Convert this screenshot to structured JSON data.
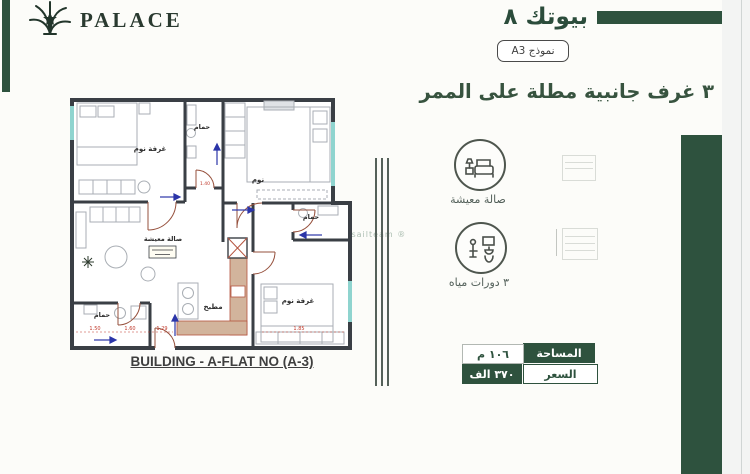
{
  "brand": {
    "palace_label": "PALACE",
    "arabic_wordmark": "بيوتك ٨",
    "model_badge": "نموذج A3"
  },
  "headline": "٣ غرف جانبية مطلة على الممر",
  "features": [
    {
      "icon": "sofa-icon",
      "label": "صالة معيشة"
    },
    {
      "icon": "toilet-icon",
      "label": "٣ دورات مياه"
    }
  ],
  "specs": {
    "area_label": "المساحة",
    "area_value": "١٠٦ م",
    "price_label": "السعر",
    "price_value": "٣٧٠ الف"
  },
  "floor_plan": {
    "caption": "BUILDING - A-FLAT NO (A-3)",
    "rooms": {
      "bedroom_tl": "غرفة نوم",
      "bath_top": "حمام",
      "bedroom_tr": "نوم",
      "bath_mid": "حمام",
      "living": "صالة معيشة",
      "kitchen": "مطبخ",
      "bath_bl": "حمام",
      "bedroom_br": "غرفة نوم"
    },
    "dimensions": [
      "1.50",
      "1.60",
      "1.29",
      "1.85",
      "1.40"
    ]
  },
  "watermark": "wasailteam ®",
  "colors": {
    "accent_green": "#2e523e",
    "wall": "#3a3f45",
    "window_teal": "#8fd4cf",
    "kitchen_tan": "#d2b49c",
    "dimension_red": "#c0392b",
    "arrow_blue": "#2b35a8"
  }
}
